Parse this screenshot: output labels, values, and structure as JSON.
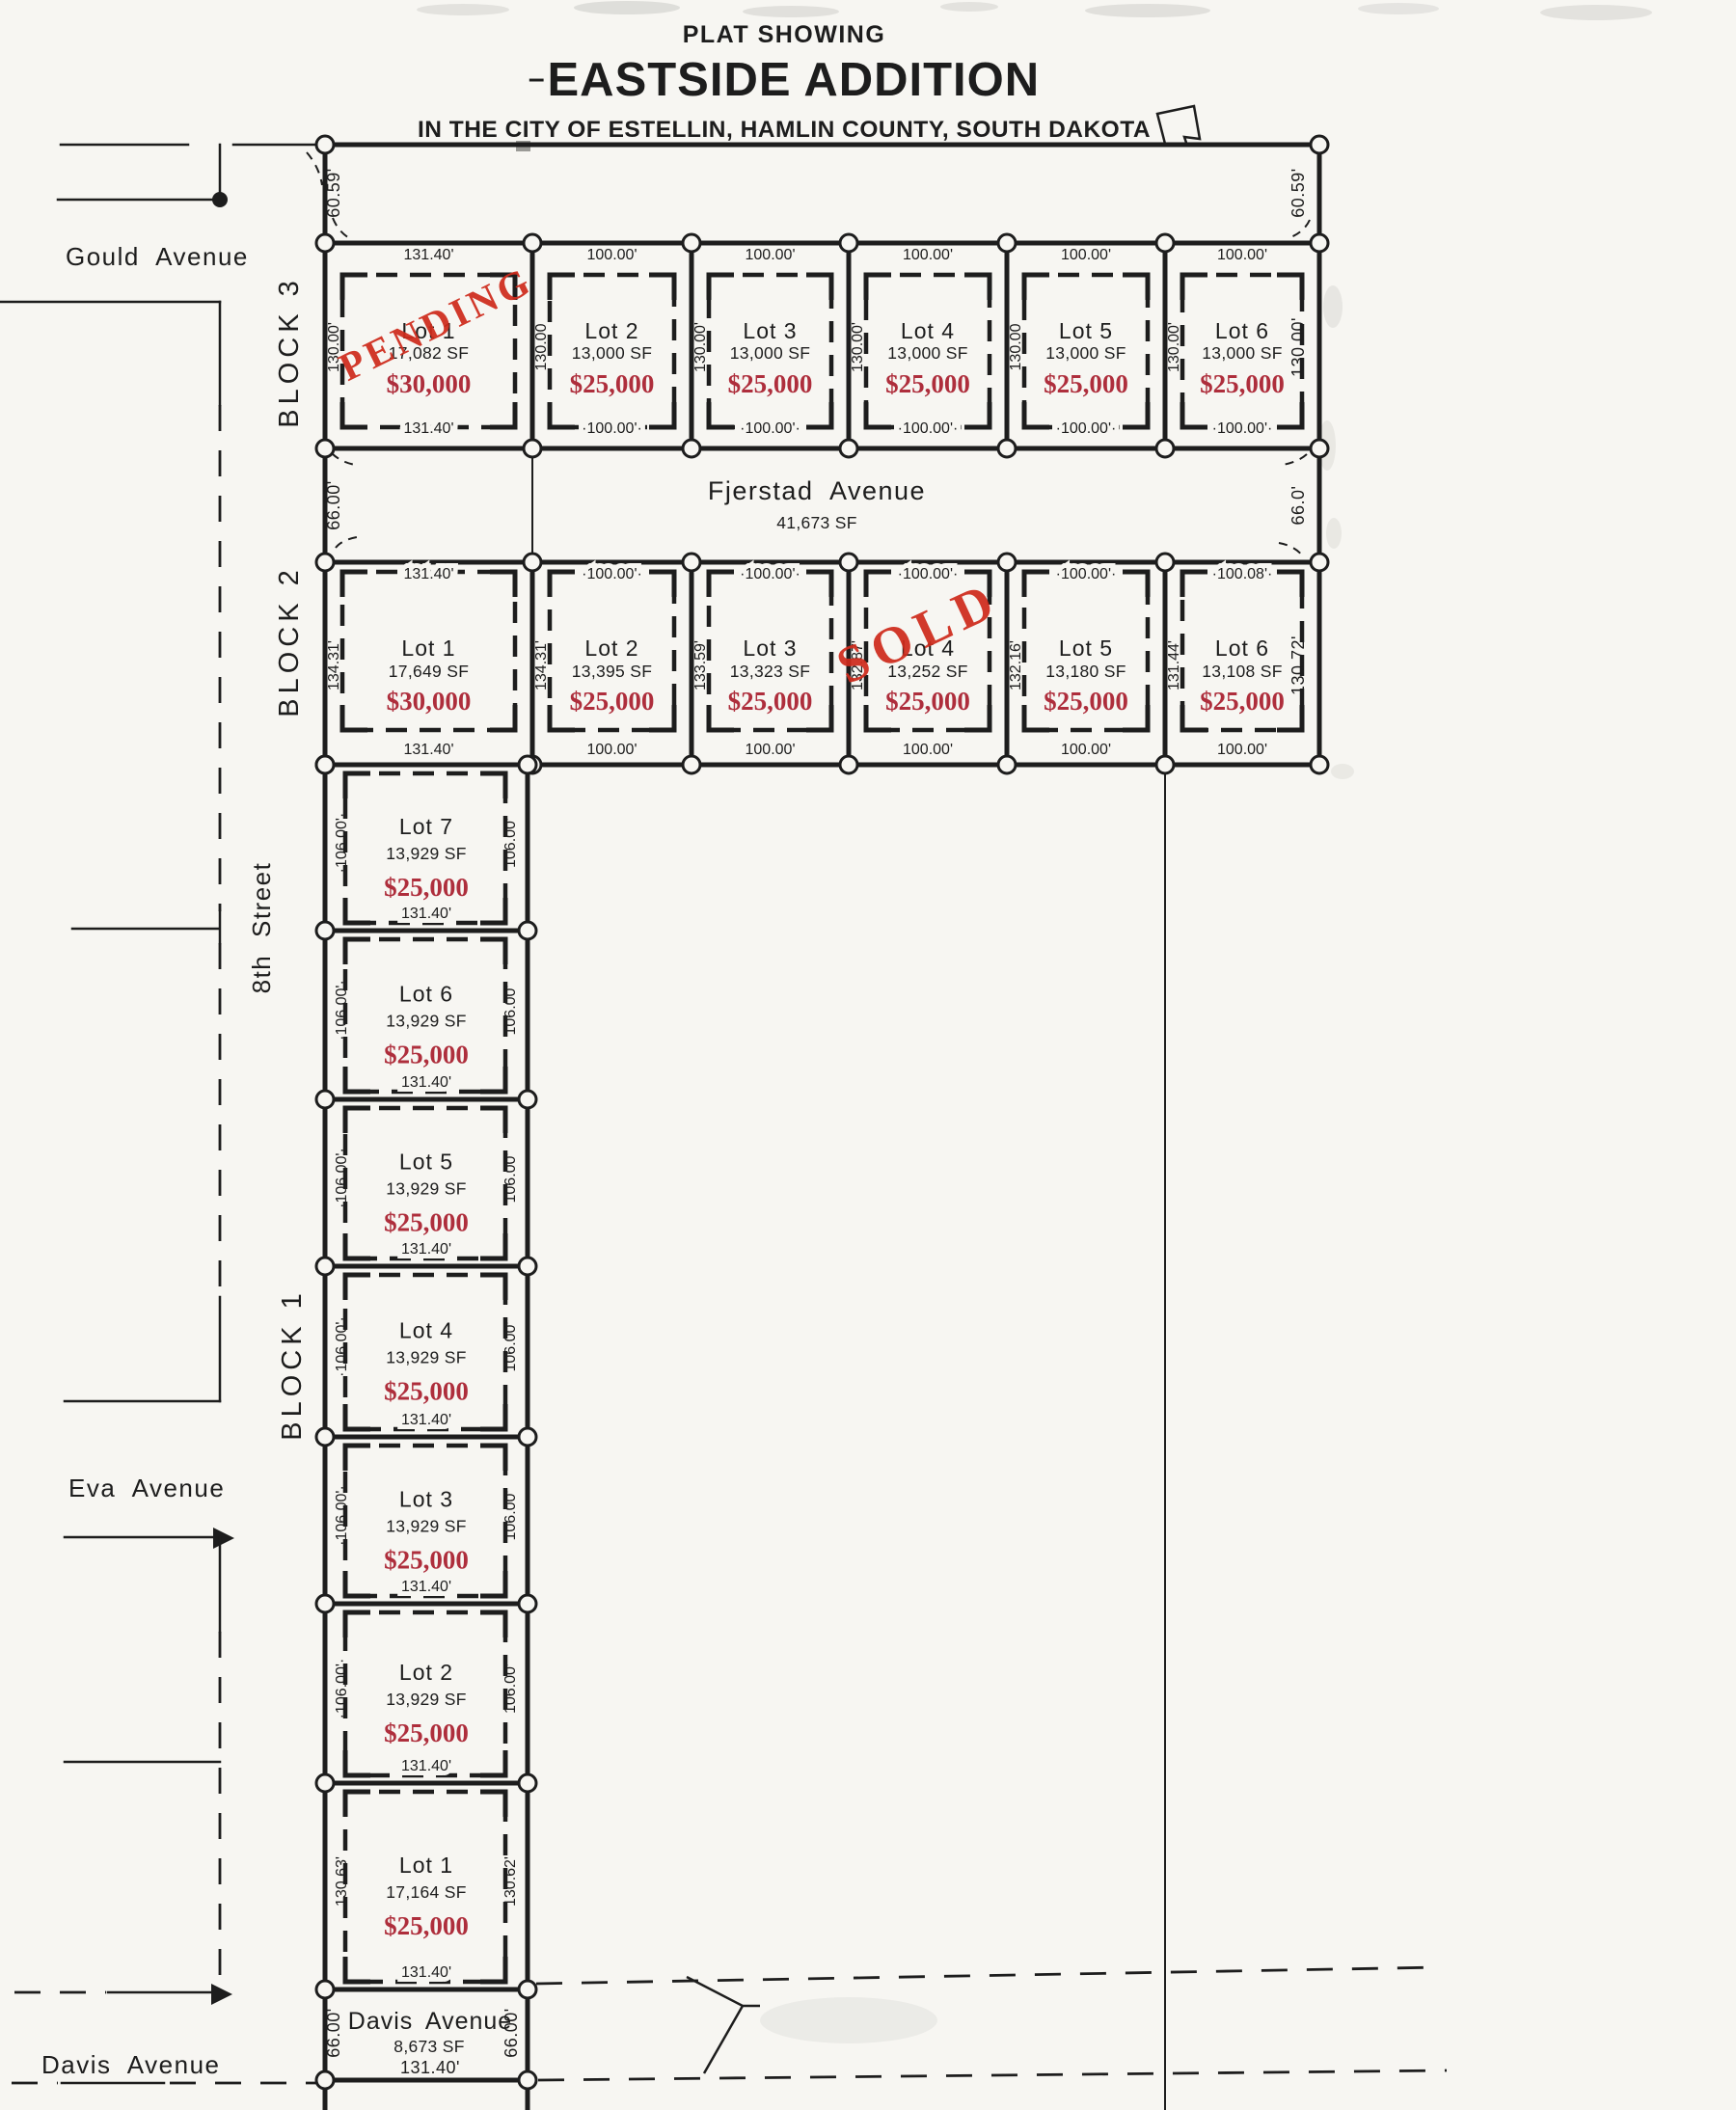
{
  "colors": {
    "paper": "#f7f6f2",
    "ink": "#1d1d1d",
    "price_red": "#ae2e3c",
    "stamp_red": "#cf2b1c"
  },
  "title": {
    "pre": "PLAT SHOWING",
    "dash": "–",
    "main": "EASTSIDE ADDITION",
    "sub": "IN THE CITY OF ESTELLIN, HAMLIN COUNTY, SOUTH DAKOTA",
    "state_icon": "south-dakota-outline"
  },
  "streets": {
    "gould": "Gould Avenue",
    "eighth": "8th Street",
    "eva": "Eva Avenue",
    "davis": "Davis Avenue"
  },
  "offsets": {
    "left": "60.59'",
    "right": "60.59'"
  },
  "fjerstad": {
    "name": "Fjerstad Avenue",
    "area": "41,673 SF",
    "left_dim": "66.00'",
    "right_dim": "66.0'"
  },
  "davis_row": {
    "name": "Davis Avenue",
    "area": "8,673 SF",
    "left_dim": "66.00'",
    "right_dim": "66.00'",
    "bottom_dim": "131.40'"
  },
  "block3": {
    "label": "BLOCK 3",
    "right_dim": "130.00'",
    "stamp": "PENDING",
    "lots": [
      {
        "name": "Lot 1",
        "area": "17,082 SF",
        "price": "$30,000",
        "top": "131.40'",
        "bottom": "131.40'",
        "side": "130.00'",
        "status": "PENDING"
      },
      {
        "name": "Lot 2",
        "area": "13,000 SF",
        "price": "$25,000",
        "top": "100.00'",
        "bottom": "·100.00'·",
        "side": "130.00"
      },
      {
        "name": "Lot 3",
        "area": "13,000 SF",
        "price": "$25,000",
        "top": "100.00'",
        "bottom": "·100.00'·",
        "side": "130.00'"
      },
      {
        "name": "Lot 4",
        "area": "13,000 SF",
        "price": "$25,000",
        "top": "100.00'",
        "bottom": "·100.00'·",
        "side": "130.00'"
      },
      {
        "name": "Lot 5",
        "area": "13,000 SF",
        "price": "$25,000",
        "top": "100.00'",
        "bottom": "·100.00'·",
        "side": "130.00"
      },
      {
        "name": "Lot 6",
        "area": "13,000 SF",
        "price": "$25,000",
        "top": "100.00'",
        "bottom": "·100.00'·",
        "side": "130.00'"
      }
    ]
  },
  "block2": {
    "label": "BLOCK 2",
    "right_dim": "130.72'",
    "stamp": "SOLD",
    "lots": [
      {
        "name": "Lot 1",
        "area": "17,649 SF",
        "price": "$30,000",
        "top": "131.40'",
        "bottom": "131.40'",
        "side": "134.31'"
      },
      {
        "name": "Lot 2",
        "area": "13,395 SF",
        "price": "$25,000",
        "top": "·100.00'·",
        "bottom": "100.00'",
        "side": "134.31'"
      },
      {
        "name": "Lot 3",
        "area": "13,323 SF",
        "price": "$25,000",
        "top": "·100.00'·",
        "bottom": "100.00'",
        "side": "133.59'"
      },
      {
        "name": "Lot 4",
        "area": "13,252 SF",
        "price": "$25,000",
        "top": "·100.00'·",
        "bottom": "100.00'",
        "side": "132.87'",
        "status": "SOLD"
      },
      {
        "name": "Lot 5",
        "area": "13,180 SF",
        "price": "$25,000",
        "top": "·100.00'·",
        "bottom": "100.00'",
        "side": "132.16'"
      },
      {
        "name": "Lot 6",
        "area": "13,108 SF",
        "price": "$25,000",
        "top": "·100.08'·",
        "bottom": "100.00'",
        "side": "131.44'"
      }
    ]
  },
  "block1": {
    "label": "BLOCK 1",
    "lots": [
      {
        "name": "Lot 7",
        "area": "13,929 SF",
        "price": "$25,000",
        "bottom": "131.40'",
        "left": "·106.00'·",
        "right": "106.00'"
      },
      {
        "name": "Lot 6",
        "area": "13,929 SF",
        "price": "$25,000",
        "bottom": "131.40'",
        "left": "·106.00'·",
        "right": "106.00'"
      },
      {
        "name": "Lot 5",
        "area": "13,929 SF",
        "price": "$25,000",
        "bottom": "131.40'",
        "left": "·106.00'·",
        "right": "106.00'"
      },
      {
        "name": "Lot 4",
        "area": "13,929 SF",
        "price": "$25,000",
        "bottom": "131.40'",
        "left": "·106.00'·",
        "right": "106.00'"
      },
      {
        "name": "Lot 3",
        "area": "13,929 SF",
        "price": "$25,000",
        "bottom": "131.40'",
        "left": "·106.00'·",
        "right": "106.00'"
      },
      {
        "name": "Lot 2",
        "area": "13,929 SF",
        "price": "$25,000",
        "bottom": "131.40'",
        "left": "·106.00'·",
        "right": "106.00'"
      },
      {
        "name": "Lot 1",
        "area": "17,164 SF",
        "price": "$25,000",
        "bottom": "131.40'",
        "left": "130.63'",
        "right": "130.62'"
      }
    ]
  }
}
